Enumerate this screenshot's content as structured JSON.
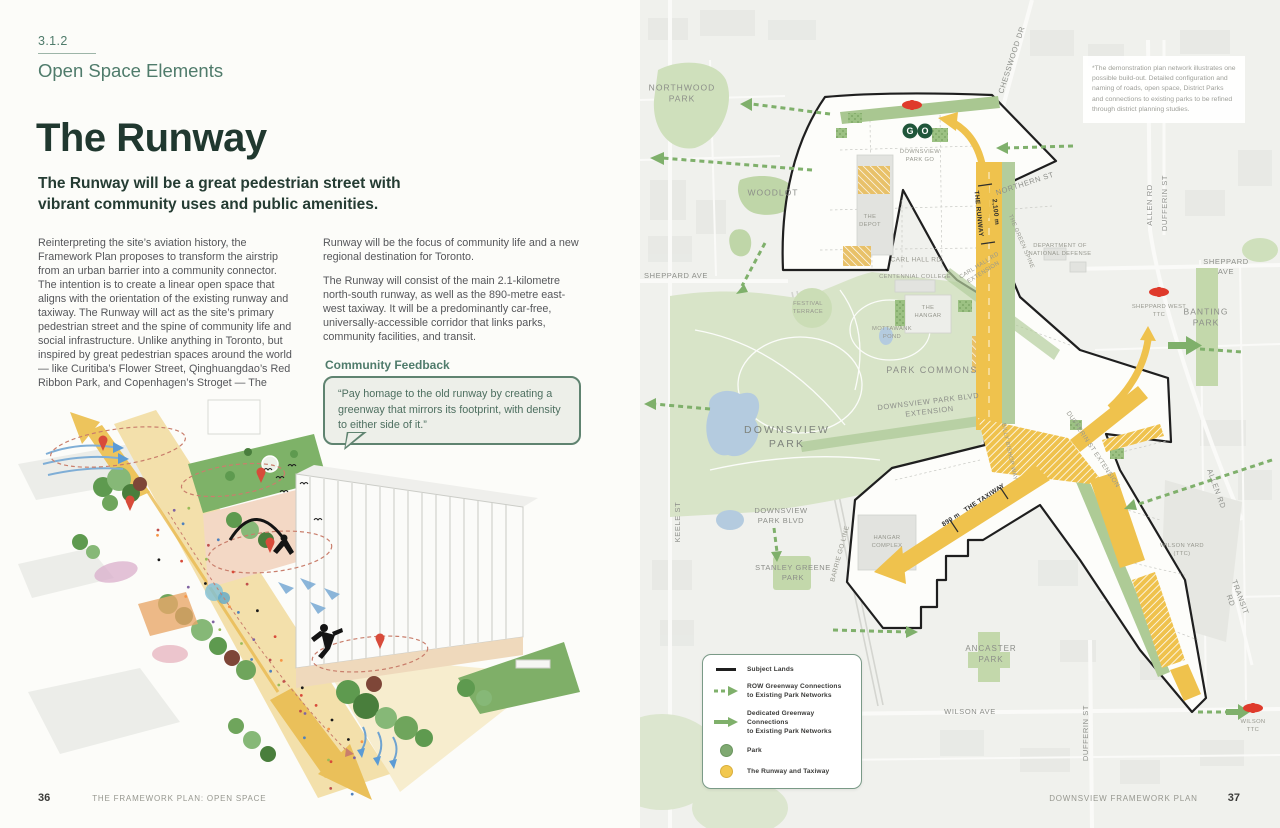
{
  "left_page": {
    "section_number": "3.1.2",
    "section_title": "Open Space Elements",
    "title": "The Runway",
    "subtitle": "The Runway will be a great pedestrian street with vibrant community uses and public amenities.",
    "body_col1": "Reinterpreting the site’s aviation history, the Framework Plan proposes to transform the airstrip from an urban barrier into a community connector. The intention is to create a linear open space that aligns with the orientation of the existing runway and taxiway. The Runway will act as the site’s primary pedestrian street and the spine of community life and social infrastructure. Unlike anything in Toronto, but inspired by great pedestrian spaces around the world — like Curitiba’s Flower Street, Qinghuangdao’s Red Ribbon Park, and Copenhagen’s Stroget — The",
    "body_col2_p1": "Runway will be the focus of community life and a new regional destination for Toronto.",
    "body_col2_p2": "The Runway will consist of the main 2.1-kilometre north-south runway, as well as the 890-metre east-west taxiway. It will be a predominantly car-free, universally-accessible corridor that links parks, community facilities, and transit.",
    "feedback_heading": "Community Feedback",
    "feedback_quote": "“Pay homage to the old runway by creating a greenway that mirrors its footprint, with density to either side of it.”",
    "footer": {
      "page_number": "36",
      "text": "THE FRAMEWORK PLAN: OPEN SPACE"
    }
  },
  "right_page": {
    "note": "*The demonstration plan network illustrates one possible build-out. Detailed configuration and naming of roads, open space, District Parks and connections to existing parks to be refined through district planning studies.",
    "legend": {
      "items": [
        {
          "id": "subject-lands",
          "label": "Subject Lands"
        },
        {
          "id": "row-greenway",
          "label": "ROW Greenway Connections\nto Existing Park Networks"
        },
        {
          "id": "dedicated-greenway",
          "label": "Dedicated Greenway Connections\nto Existing Park Networks"
        },
        {
          "id": "park",
          "label": "Park"
        },
        {
          "id": "runway-taxiway",
          "label": "The Runway and Taxiway"
        }
      ]
    },
    "labels": {
      "northwood_park": "NORTHWOOD\nPARK",
      "woodlot": "WOODLOT",
      "sheppard_ave_w": "SHEPPARD AVE",
      "keele_st": "KEELE ST",
      "chesswood_dr": "CHESSWOOD DR",
      "northern_st": "NORTHERN ST",
      "green_spine": "THE GREEN SPINE",
      "runway_measure": "2,100 m",
      "runway_name": "THE RUNWAY",
      "carl_hall_rd_ext": "CARL HALL RD\nEXTENSION",
      "dept_defense": "DEPARTMENT OF\nNATIONAL DEFENSE",
      "sheppard_ave_e": "SHEPPARD AVE",
      "allen_rd_n": "ALLEN RD",
      "dufferin_st_n": "DUFFERIN ST",
      "sheppard_west_ttc": "SHEPPARD WEST\nTTC",
      "banting_park": "BANTING\nPARK",
      "carl_hall_rd": "CARL HALL RD",
      "centennial_college": "CENTENNIAL COLLEGE",
      "the_depot": "THE\nDEPOT",
      "festival_terrace": "FESTIVAL\nTERRACE",
      "the_hangar": "THE\nHANGAR",
      "pond": "MOTTAWANK\nPOND",
      "park_commons": "PARK COMMONS",
      "downsview_park_blvd_ext": "DOWNSVIEW PARK BLVD\nEXTENSION",
      "downsview_park": "DOWNSVIEW\nPARK",
      "downsview_park_blvd": "DOWNSVIEW\nPARK BLVD",
      "stanley_greene_park": "STANLEY GREENE\nPARK",
      "barrie_go_line": "BARRIE GO LINE",
      "hangar_complex": "HANGAR\nCOMPLEX",
      "taxiway_measure": "890 m",
      "taxiway_name": "THE TAXIWAY",
      "billy_bishop_way": "BILLY BISHOP WAY",
      "dufferin_st_ext": "DUFFERIN ST EXTENSION",
      "allen_rd_mid": "ALLEN RD",
      "wilson_yard": "WILSON YARD\n(TTC)",
      "transit_rd": "TRANSIT RD",
      "ancaster_park": "ANCASTER\nPARK",
      "wilson_ave": "WILSON AVE",
      "wilson_ttc": "WILSON\nTTC",
      "dufferin_st_s": "DUFFERIN ST",
      "downsview_park_go": "DOWNSVIEW\nPARK GO"
    },
    "footer": {
      "text": "DOWNSVIEW FRAMEWORK PLAN",
      "page_number": "37"
    }
  },
  "colors": {
    "accent_green": "#4F7B6B",
    "title_dark": "#20382F",
    "runway_yellow": "#EFC24D",
    "park_green": "#D8E4C8",
    "district_park_green": "#7FA971",
    "greenway_arrow": "#7FB06B",
    "ttc_red": "#DF3A2B",
    "go_green": "#20563A"
  }
}
